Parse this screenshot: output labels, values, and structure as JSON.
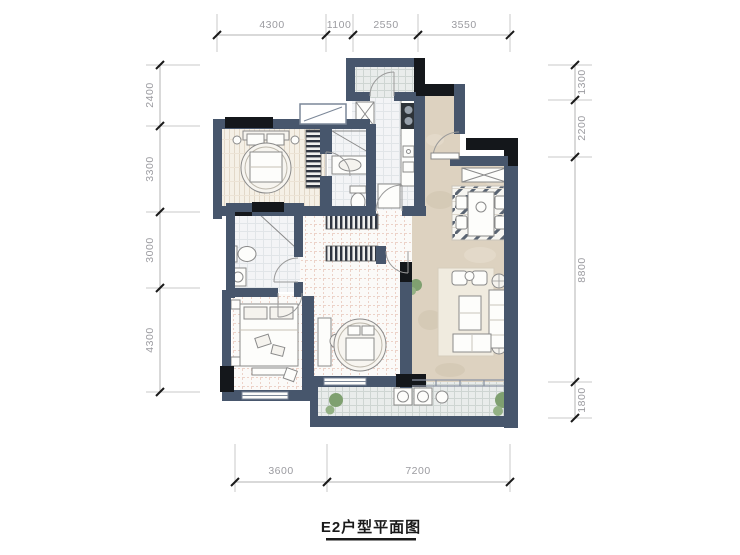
{
  "title": {
    "text": "E2户型平面图"
  },
  "dimensions": {
    "top": [
      "4300",
      "1100",
      "2550",
      "3550"
    ],
    "left": [
      "2400",
      "3300",
      "3000",
      "4300"
    ],
    "right": [
      "1300",
      "2200",
      "8800",
      "1800"
    ],
    "bottom": [
      "3600",
      "7200"
    ]
  },
  "colors": {
    "wall_slate": "#47566c",
    "wall_black": "#14171b",
    "floor_wood": "#f5f0e6",
    "floor_tan": "#ddd2c0",
    "floor_tile": "#f3f4f6",
    "balcony_tile": "#e9eceb",
    "rug_stripe": "#5a6472",
    "plant_green": "#7fa070",
    "dimension_text": "#9b9ba0"
  },
  "icons": [
    "round-bed-icon",
    "double-bed-icon",
    "wardrobe-icon",
    "fridge-icon",
    "stove-icon",
    "sink-icon",
    "toilet-icon",
    "shower-icon",
    "basin-icon",
    "sofa-icon",
    "coffee-table-icon",
    "dining-table-icon",
    "chair-icon",
    "washer-icon",
    "plant-icon",
    "door-swing-icon",
    "ac-platform-icon"
  ]
}
